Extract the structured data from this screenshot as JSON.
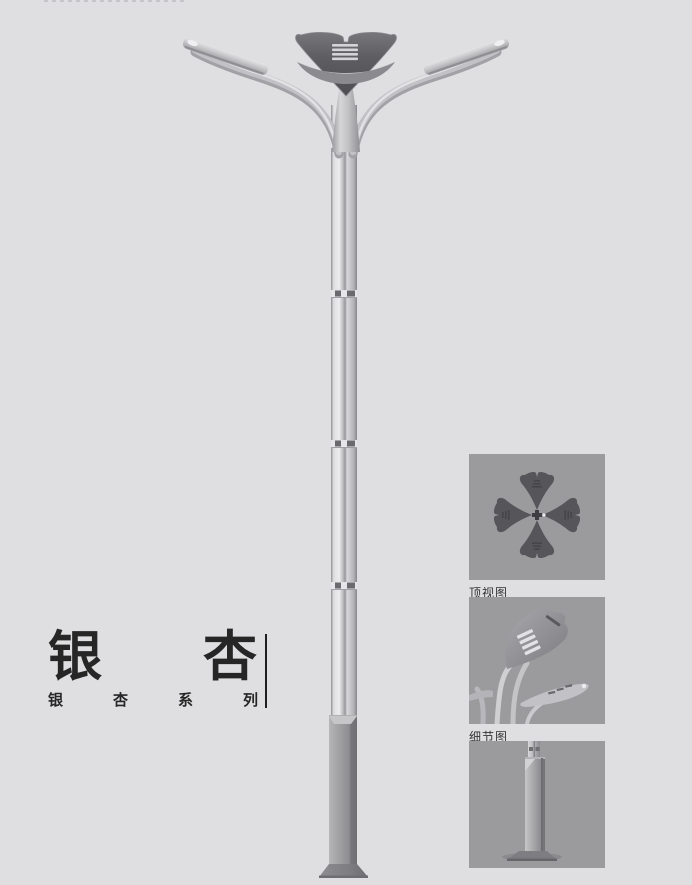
{
  "page": {
    "background": "#dfdfe1"
  },
  "title_block": {
    "title": "银杏",
    "chars": [
      "银",
      "杏"
    ],
    "subtitle": "银杏系列",
    "subtitle_chars": [
      "银",
      "杏",
      "系",
      "列"
    ]
  },
  "panels": [
    {
      "caption": "顶视图"
    },
    {
      "caption": "细节图"
    },
    {
      "caption": ""
    }
  ],
  "illustration_icons": {
    "main": "ginkgo-streetlamp-render",
    "panel_1": "lamp-top-view",
    "panel_2": "lamp-head-detail",
    "panel_3": "lamp-base-detail"
  },
  "colors": {
    "page_bg": "#dfdfe1",
    "panel_bg": "#9b9b9d",
    "title_text": "#262626",
    "caption_text": "#333333",
    "divider": "#1f1f1f",
    "head_dark": "#56565a",
    "head_mid": "#6e6e72",
    "slat_light": "#d4d4d6",
    "collar": "#8b8b8f",
    "arm": "#c2c2c6",
    "arm_shadow": "#a2a2a6",
    "arm_highlight": "#e2e2e4",
    "fixture": "#c6c6c8",
    "pole_edge": "#8e8e92",
    "joint_dark": "#6a6a6e",
    "base_plate": "#7e7e82"
  }
}
